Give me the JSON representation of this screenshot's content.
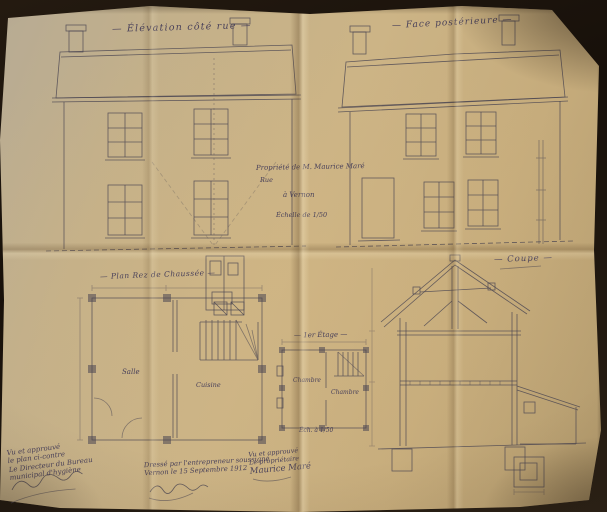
{
  "photo": {
    "paper_color": "#ccb486",
    "ink_color": "#4b4552",
    "background_color": "#17100a"
  },
  "titles": {
    "street_elevation": "— Élévation côté rue —",
    "rear_elevation": "— Face postérieure —",
    "ground_plan": "— Plan Rez de Chaussée —",
    "first_floor": "— 1er Étage —",
    "section": "— Coupe —"
  },
  "title_block": {
    "line1": "Propriété de M. Maurice Maré",
    "line2": "Rue",
    "line3": "à Vernon",
    "line4": "Échelle de 1/50"
  },
  "plan_labels": {
    "salle": "Salle",
    "cuisine": "Cuisine",
    "chambre_left": "Chambre",
    "chambre_right": "Chambre",
    "first_floor_scale": "Éch. à 1/50"
  },
  "annotations": {
    "hygiene_office": {
      "lines": [
        "Vu et approuvé",
        "le plan ci-contre",
        "Le Directeur du Bureau",
        "municipal d'hygiène"
      ]
    },
    "contractor": {
      "lines": [
        "Dressé par l'entrepreneur soussigné",
        "Vernon le 15 Septembre 1912"
      ]
    },
    "owner": {
      "lines": [
        "Vu et approuvé",
        "Le propriétaire"
      ],
      "signature": "Maurice Maré"
    }
  }
}
